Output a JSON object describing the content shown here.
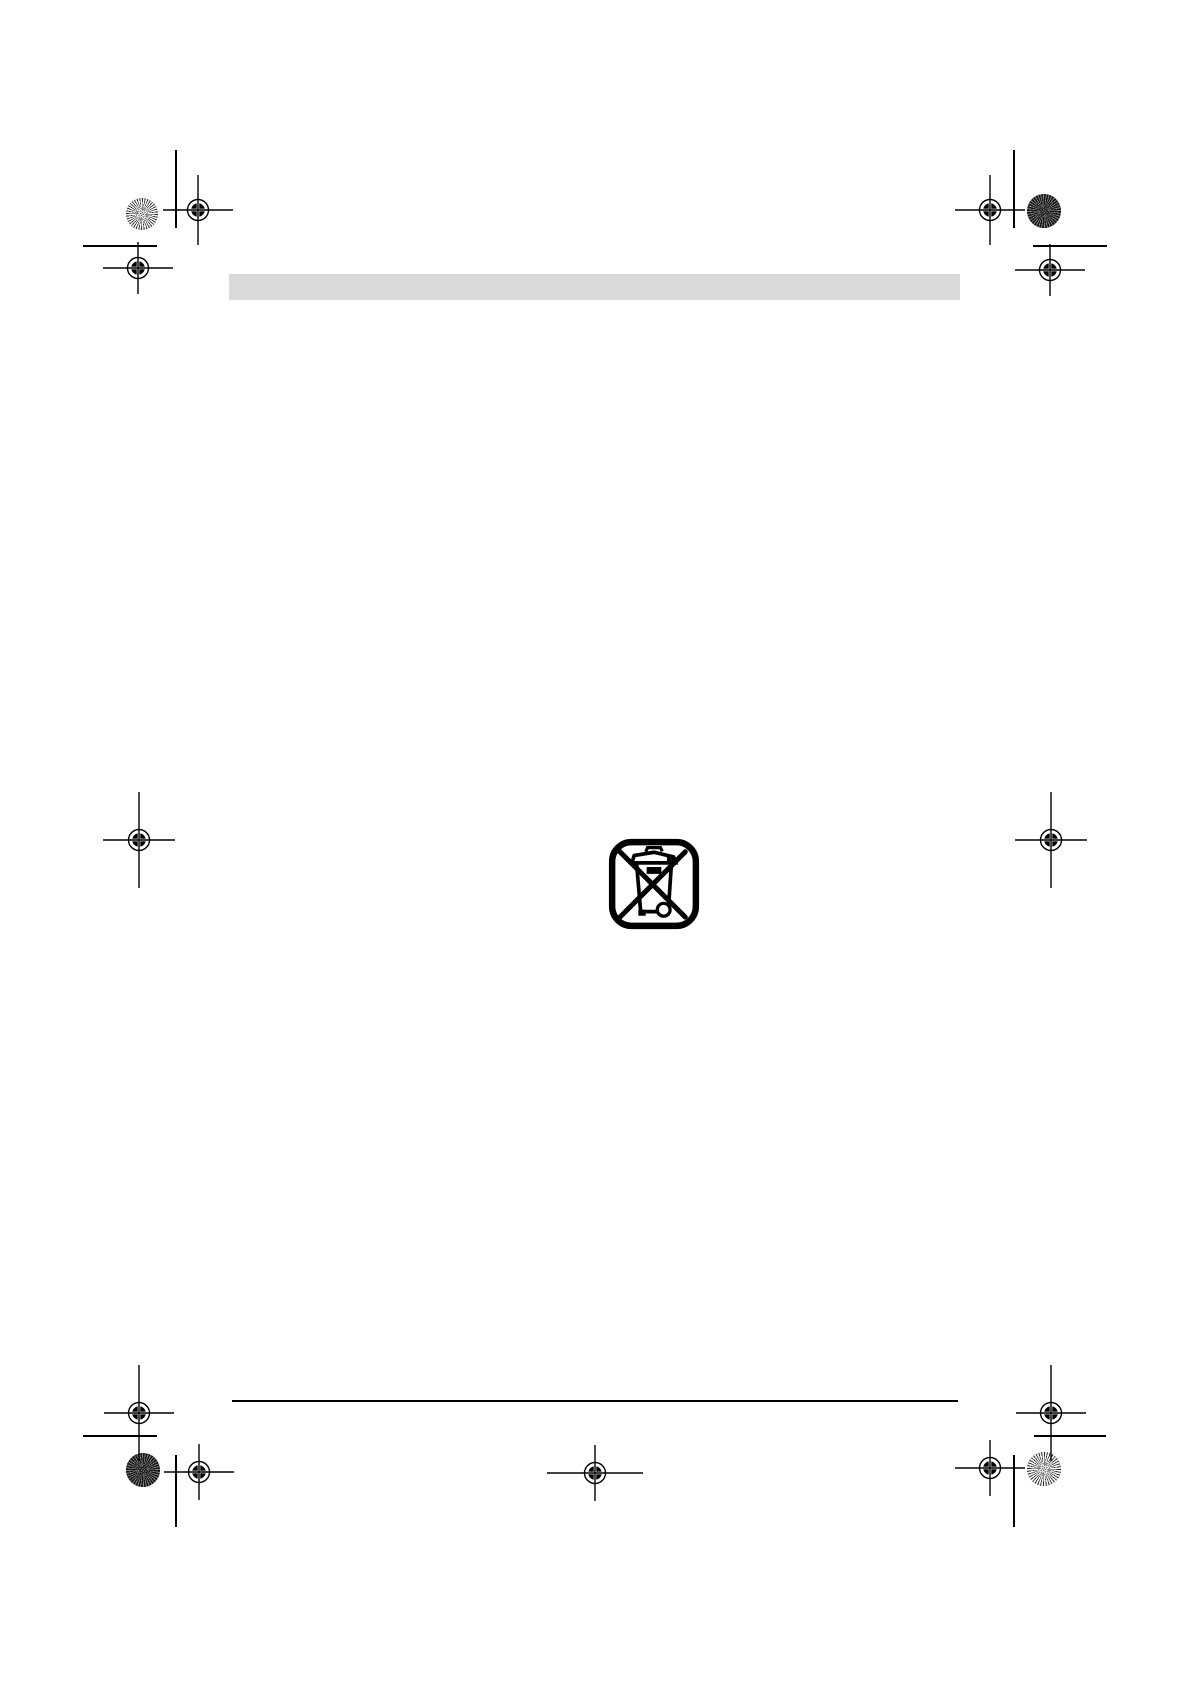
{
  "page": {
    "kind": "blank prepress document page with printer marks",
    "background_color": "#ffffff",
    "width": 1190,
    "height": 1684
  },
  "header_bar": {
    "color": "#d9d9d9",
    "x": 229,
    "y": 274,
    "width": 731,
    "height": 26
  },
  "footer_rule": {
    "color": "#000000",
    "x": 232,
    "y": 1400,
    "width": 726,
    "height": 2
  },
  "weee_symbol": {
    "icon": "weee-crossed-out-wheeled-bin-icon",
    "color": "#000000",
    "x": 608,
    "y": 838,
    "size": 92
  },
  "printer_marks": {
    "mark_color": "#000000",
    "registration_targets": [
      {
        "id": "top-left-inner",
        "x": 198,
        "y": 210,
        "h": 70,
        "v": 70
      },
      {
        "id": "top-left-outer",
        "x": 138,
        "y": 268,
        "h": 70,
        "v": 52
      },
      {
        "id": "top-right-inner",
        "x": 990,
        "y": 210,
        "h": 70,
        "v": 70
      },
      {
        "id": "top-right-outer",
        "x": 1050,
        "y": 270,
        "h": 70,
        "v": 52
      },
      {
        "id": "middle-left",
        "x": 139,
        "y": 840,
        "h": 72,
        "v": 96
      },
      {
        "id": "middle-right",
        "x": 1051,
        "y": 840,
        "h": 72,
        "v": 96
      },
      {
        "id": "bottom-left-outer",
        "x": 139,
        "y": 1413,
        "h": 70,
        "v": 96
      },
      {
        "id": "bottom-left-inner",
        "x": 199,
        "y": 1472,
        "h": 70,
        "v": 56
      },
      {
        "id": "bottom-right-outer",
        "x": 1051,
        "y": 1413,
        "h": 70,
        "v": 96
      },
      {
        "id": "bottom-right-inner",
        "x": 990,
        "y": 1468,
        "h": 70,
        "v": 56
      },
      {
        "id": "bottom-center",
        "x": 595,
        "y": 1473,
        "h": 96,
        "v": 56
      }
    ],
    "star_targets": [
      {
        "id": "top-left",
        "x": 142,
        "y": 214,
        "r": 16,
        "variant": "light"
      },
      {
        "id": "top-right",
        "x": 1044,
        "y": 211,
        "r": 17,
        "variant": "dark"
      },
      {
        "id": "bottom-left",
        "x": 143,
        "y": 1470,
        "r": 17,
        "variant": "dark"
      },
      {
        "id": "bottom-right",
        "x": 1044,
        "y": 1469,
        "r": 17,
        "variant": "light"
      }
    ],
    "crop_lines": [
      {
        "id": "top-left-vertical",
        "x1": 176,
        "y1": 150,
        "x2": 176,
        "y2": 228
      },
      {
        "id": "top-right-vertical",
        "x1": 1014,
        "y1": 150,
        "x2": 1014,
        "y2": 228
      },
      {
        "id": "bottom-left-vertical",
        "x1": 176,
        "y1": 1455,
        "x2": 176,
        "y2": 1527
      },
      {
        "id": "bottom-right-vertical",
        "x1": 1014,
        "y1": 1455,
        "x2": 1014,
        "y2": 1527
      },
      {
        "id": "top-left-horizontal",
        "x1": 83,
        "y1": 246,
        "x2": 157,
        "y2": 246
      },
      {
        "id": "top-right-horizontal",
        "x1": 1033,
        "y1": 246,
        "x2": 1107,
        "y2": 246
      },
      {
        "id": "bottom-left-horizontal",
        "x1": 83,
        "y1": 1436,
        "x2": 157,
        "y2": 1436
      },
      {
        "id": "bottom-right-horizontal",
        "x1": 1034,
        "y1": 1436,
        "x2": 1106,
        "y2": 1436
      }
    ]
  }
}
